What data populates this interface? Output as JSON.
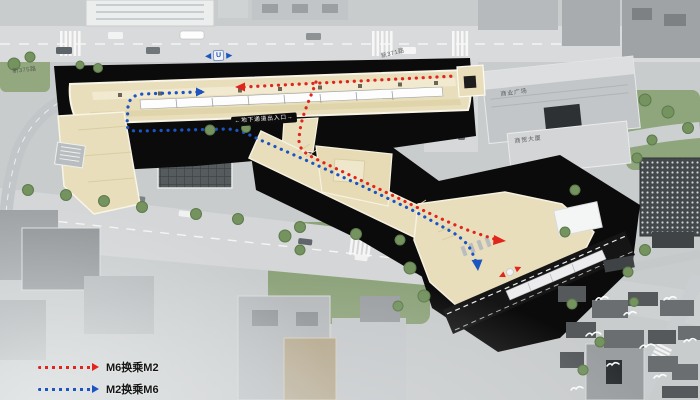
{
  "legend": {
    "items": [
      {
        "id": "m6-to-m2",
        "label": "M6换乘M2",
        "color": "#e1251c",
        "style": "dotted-arrow"
      },
      {
        "id": "m2-to-m6",
        "label": "M2换乘M6",
        "color": "#1c55c2",
        "style": "dotted-arrow"
      }
    ]
  },
  "labels": {
    "underpass_badge": "←地下通道出入口→",
    "road_left": "新375路",
    "road_right": "新371路",
    "building_upper": "商业广场",
    "building_lower": "商贸大厦"
  },
  "markers": {
    "m2_direction": {
      "left": "◀",
      "center": "U",
      "right": "▶",
      "color": "#1c55c2"
    },
    "m6_direction": {
      "left": "◀",
      "right": "▶",
      "color": "#e1251c"
    }
  },
  "routes": [
    {
      "name": "M6换乘M2",
      "color": "#e1251c"
    },
    {
      "name": "M2换乘M6",
      "color": "#1c55c2"
    }
  ],
  "palette": {
    "city_gray": "#c9cccd",
    "road_gray": "#d8dadb",
    "excavation_black": "#0b0b0c",
    "station_beige": "#e9debb",
    "lawn_green": "#8fa57c"
  }
}
